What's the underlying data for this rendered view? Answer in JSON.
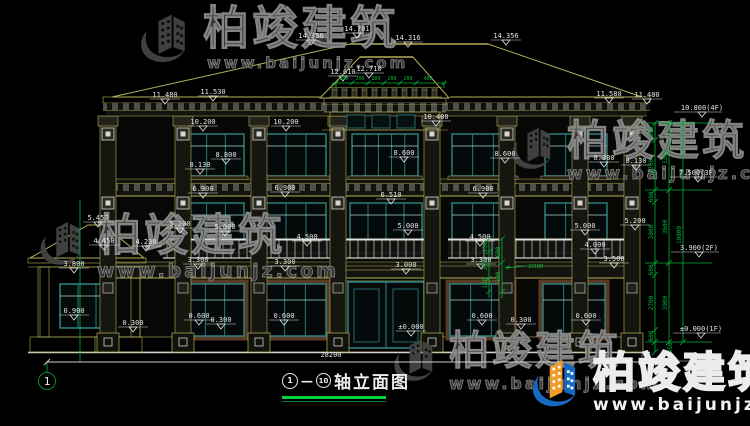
{
  "title": {
    "axis_start": "1",
    "axis_end": "10",
    "separator": "—",
    "name": "轴立面图"
  },
  "axis": {
    "bubble_label": "1"
  },
  "watermark": {
    "brand": "柏竣建筑",
    "url": "www.baijunjz.com"
  },
  "totals": {
    "width": "28200"
  },
  "levels_right": [
    {
      "t": "10.800(4F)",
      "x": 702,
      "y": 110
    },
    {
      "t": "7.500(3F)",
      "x": 698,
      "y": 175
    },
    {
      "t": "3.900(2F)",
      "x": 699,
      "y": 250
    },
    {
      "t": "±0.000(1F)",
      "x": 701,
      "y": 331
    },
    {
      "t": "-0.450",
      "x": 700,
      "y": 359
    }
  ],
  "dim_labels": [
    {
      "t": "14.356",
      "x": 311,
      "y": 38
    },
    {
      "t": "14.701",
      "x": 357,
      "y": 31
    },
    {
      "t": "14.316",
      "x": 408,
      "y": 40
    },
    {
      "t": "14.356",
      "x": 506,
      "y": 38
    },
    {
      "t": "12.610",
      "x": 343,
      "y": 74
    },
    {
      "t": "12.710",
      "x": 369,
      "y": 71
    },
    {
      "t": "11.480",
      "x": 165,
      "y": 97
    },
    {
      "t": "11.530",
      "x": 213,
      "y": 94
    },
    {
      "t": "11.580",
      "x": 609,
      "y": 96
    },
    {
      "t": "11.480",
      "x": 647,
      "y": 97
    },
    {
      "t": "10.200",
      "x": 203,
      "y": 124
    },
    {
      "t": "10.200",
      "x": 286,
      "y": 124
    },
    {
      "t": "10.400",
      "x": 436,
      "y": 119
    },
    {
      "t": "8.800",
      "x": 226,
      "y": 157
    },
    {
      "t": "8.130",
      "x": 200,
      "y": 167
    },
    {
      "t": "8.600",
      "x": 404,
      "y": 155
    },
    {
      "t": "8.600",
      "x": 505,
      "y": 156
    },
    {
      "t": "8.380",
      "x": 604,
      "y": 160
    },
    {
      "t": "8.130",
      "x": 636,
      "y": 163
    },
    {
      "t": "6.900",
      "x": 203,
      "y": 191
    },
    {
      "t": "6.900",
      "x": 285,
      "y": 190
    },
    {
      "t": "6.510",
      "x": 391,
      "y": 197
    },
    {
      "t": "6.900",
      "x": 483,
      "y": 191
    },
    {
      "t": "5.457",
      "x": 98,
      "y": 220
    },
    {
      "t": "5.200",
      "x": 180,
      "y": 226
    },
    {
      "t": "5.000",
      "x": 225,
      "y": 229
    },
    {
      "t": "5.000",
      "x": 408,
      "y": 228
    },
    {
      "t": "5.000",
      "x": 585,
      "y": 228
    },
    {
      "t": "5.200",
      "x": 635,
      "y": 223
    },
    {
      "t": "4.500",
      "x": 307,
      "y": 239
    },
    {
      "t": "4.500",
      "x": 480,
      "y": 239
    },
    {
      "t": "4.450",
      "x": 104,
      "y": 243
    },
    {
      "t": "4.230",
      "x": 146,
      "y": 244
    },
    {
      "t": "4.000",
      "x": 595,
      "y": 247
    },
    {
      "t": "3.800",
      "x": 74,
      "y": 266
    },
    {
      "t": "3.300",
      "x": 198,
      "y": 262
    },
    {
      "t": "3.300",
      "x": 285,
      "y": 264
    },
    {
      "t": "3.300",
      "x": 481,
      "y": 262
    },
    {
      "t": "3.000",
      "x": 406,
      "y": 267
    },
    {
      "t": "3.500",
      "x": 614,
      "y": 261
    },
    {
      "t": "0.900",
      "x": 74,
      "y": 313
    },
    {
      "t": "0.300",
      "x": 133,
      "y": 325
    },
    {
      "t": "0.600",
      "x": 199,
      "y": 318
    },
    {
      "t": "0.300",
      "x": 221,
      "y": 322
    },
    {
      "t": "0.600",
      "x": 284,
      "y": 318
    },
    {
      "t": "±0.000",
      "x": 411,
      "y": 329
    },
    {
      "t": "0.600",
      "x": 482,
      "y": 318
    },
    {
      "t": "0.300",
      "x": 521,
      "y": 322
    },
    {
      "t": "0.600",
      "x": 586,
      "y": 318
    }
  ],
  "green_v_labels": [
    {
      "t": "600",
      "x": 653,
      "y": 132
    },
    {
      "t": "2700",
      "x": 653,
      "y": 166
    },
    {
      "t": "600",
      "x": 653,
      "y": 197
    },
    {
      "t": "3000",
      "x": 653,
      "y": 232
    },
    {
      "t": "600",
      "x": 653,
      "y": 270
    },
    {
      "t": "2700",
      "x": 653,
      "y": 303
    },
    {
      "t": "600",
      "x": 653,
      "y": 336
    },
    {
      "t": "3300",
      "x": 667,
      "y": 157
    },
    {
      "t": "3600",
      "x": 667,
      "y": 227
    },
    {
      "t": "3900",
      "x": 667,
      "y": 303
    },
    {
      "t": "10800",
      "x": 681,
      "y": 235
    },
    {
      "t": "450",
      "x": 672,
      "y": 348
    },
    {
      "t": "150",
      "x": 487,
      "y": 247
    },
    {
      "t": "300",
      "x": 487,
      "y": 265
    },
    {
      "t": "150",
      "x": 487,
      "y": 283
    },
    {
      "t": "600",
      "x": 500,
      "y": 252
    },
    {
      "t": "300",
      "x": 500,
      "y": 277
    }
  ],
  "green_h_labels": [
    {
      "t": "200",
      "x": 344
    },
    {
      "t": "200",
      "x": 360
    },
    {
      "t": "200",
      "x": 376
    },
    {
      "t": "200",
      "x": 392
    },
    {
      "t": "200",
      "x": 408
    },
    {
      "t": "400",
      "x": 428
    }
  ],
  "green_note": "2X18M",
  "theme": {
    "line": "#b5b158",
    "green": "#00b43c",
    "teal": "#2e8585",
    "brown": "#5a3a24",
    "white": "#e4e4e4",
    "wm_gray": "#424242",
    "wm_blue": "#1668c0",
    "wm_orange": "#f09a28"
  }
}
